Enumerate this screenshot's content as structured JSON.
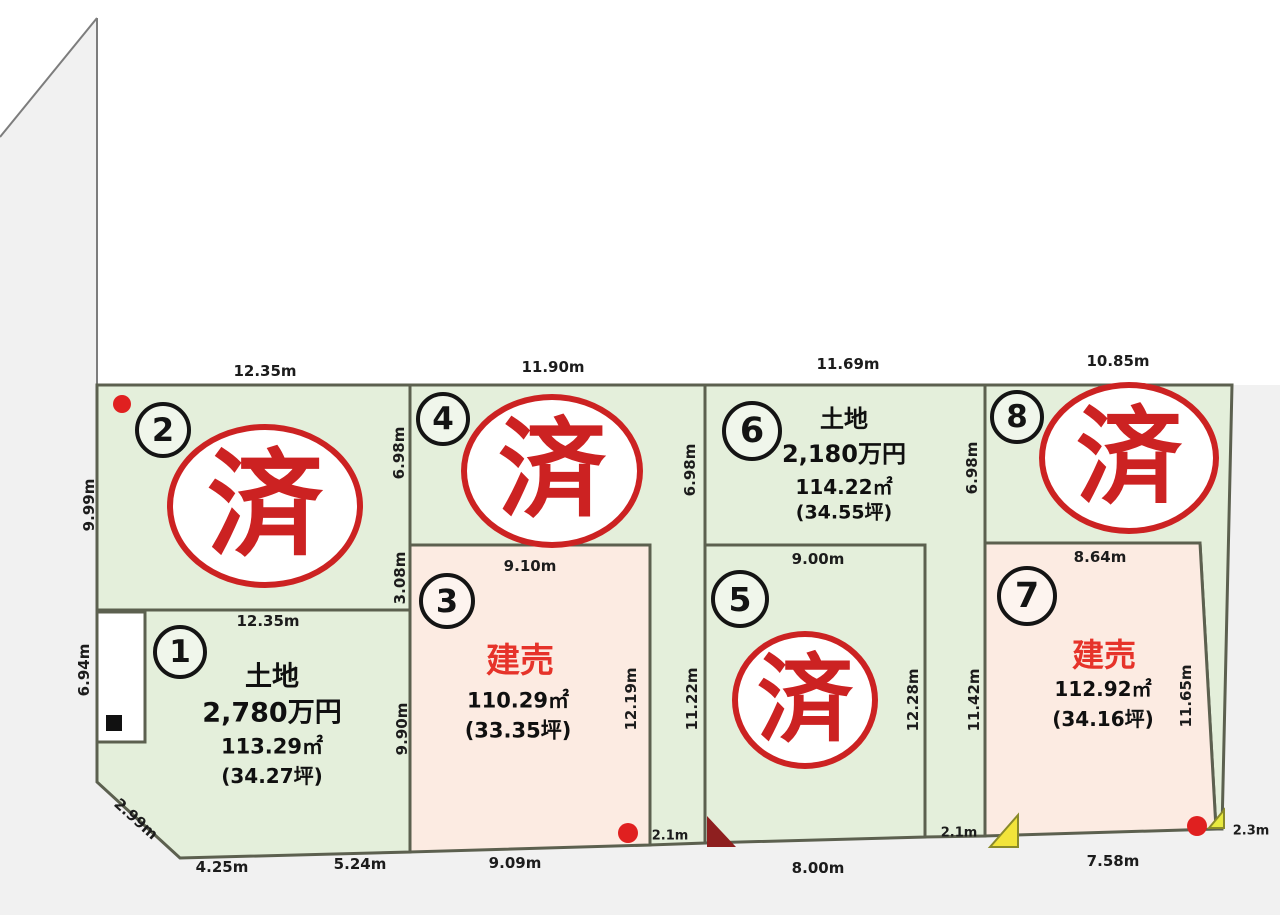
{
  "lots": {
    "lot1": {
      "number": "1",
      "type": "土地",
      "price": "2,780万円",
      "area": "113.29㎡",
      "tsubo": "(34.27坪)"
    },
    "lot2": {
      "number": "2",
      "stamp": "済"
    },
    "lot3": {
      "number": "3",
      "type": "建売",
      "area": "110.29㎡",
      "tsubo": "(33.35坪)"
    },
    "lot4": {
      "number": "4",
      "stamp": "済"
    },
    "lot5": {
      "number": "5",
      "stamp": "済"
    },
    "lot6": {
      "number": "6",
      "type": "土地",
      "price": "2,180万円",
      "area": "114.22㎡",
      "tsubo": "(34.55坪)"
    },
    "lot7": {
      "number": "7",
      "type": "建売",
      "area": "112.92㎡",
      "tsubo": "(34.16坪)"
    },
    "lot8": {
      "number": "8",
      "stamp": "済"
    }
  },
  "dimensions": {
    "top_lot2": "12.35m",
    "top_lot4": "11.90m",
    "top_lot6": "11.69m",
    "top_lot8": "10.85m",
    "left_upper": "9.99m",
    "left_lower": "6.94m",
    "lot1_top": "12.35m",
    "lot1_bottom_left": "4.25m",
    "lot1_bottom_right": "5.24m",
    "lot1_corner": "2.99m",
    "edge2_upper": "6.98m",
    "edge2_mid": "3.08m",
    "edge2_lower": "9.90m",
    "lot3_top": "9.10m",
    "lot3_right": "12.19m",
    "lot3_bottom": "9.09m",
    "edge3_upper": "6.98m",
    "lot5_left": "11.22m",
    "lot5_top": "9.00m",
    "lot5_right": "12.28m",
    "lot5_bottom": "8.00m",
    "edge4_upper": "6.98m",
    "lot7_left": "11.42m",
    "lot7_top": "8.64m",
    "lot7_right": "11.65m",
    "lot7_bottom": "7.58m",
    "strip4_width": "2.1m",
    "strip6_width": "2.1m",
    "strip8_width": "2.3m"
  },
  "colors": {
    "land_green": "#e4efdb",
    "land_pink": "#fcebe2",
    "border": "#5c604f",
    "stamp_red": "#cc2222",
    "sale_red": "#e6332a",
    "marker_red": "#e02020",
    "marker_dark_red": "#8e1f1f",
    "marker_yellow": "#f2e43a",
    "marker_black": "#111111"
  }
}
